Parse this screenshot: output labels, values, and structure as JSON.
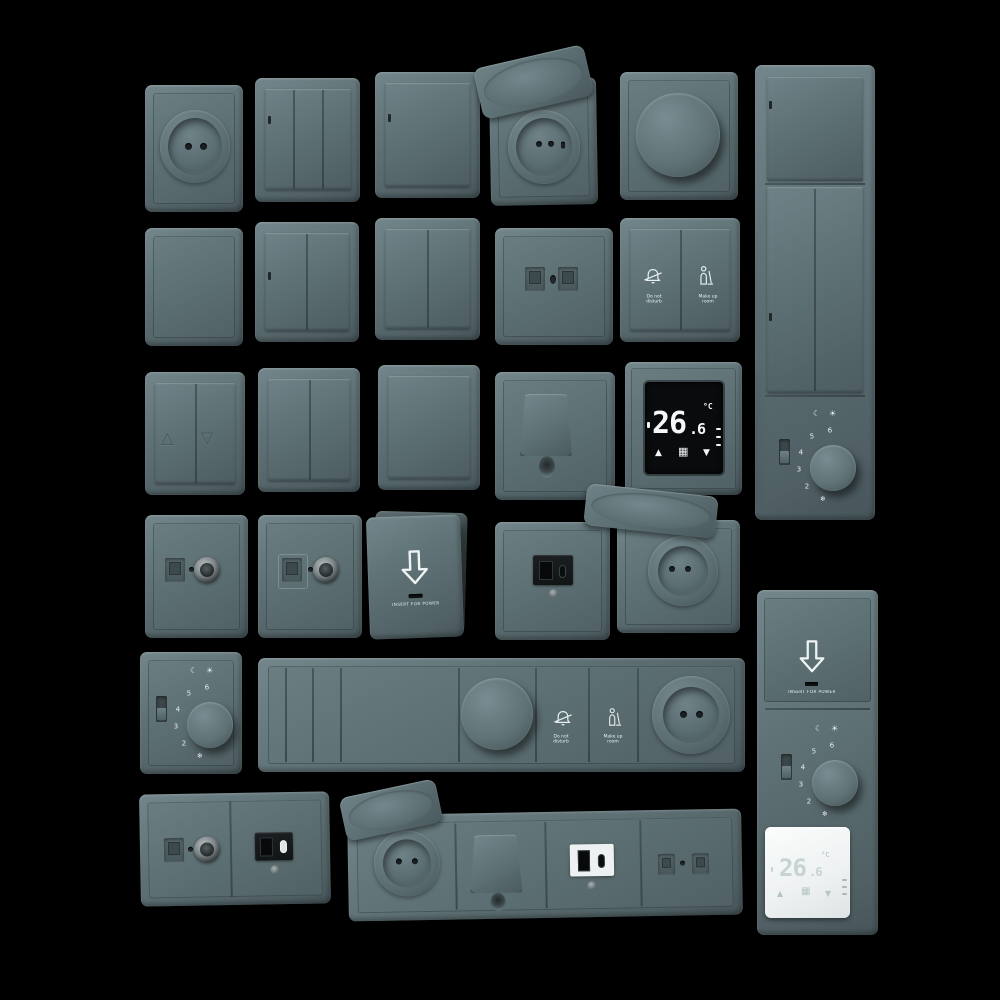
{
  "scene": {
    "background_color": "#000000",
    "plate_color": "#5f7276",
    "plate_highlight": "#72868b",
    "plate_shadow": "#46555a",
    "module_dark_color": "#17191b",
    "screen_color": "#0a0b0c",
    "white_plate_color": "#f0f3f3",
    "digit_color_black_screen": "#f4f8f8",
    "digit_color_white_plate": "#c6d2d4"
  },
  "labels": {
    "insert_for_power": "INSERT FOR POWER",
    "do_not_line1": "Do not",
    "do_not_line2": "disturb",
    "make_up_line1": "Make up",
    "make_up_line2": "room"
  },
  "thermostat_black": {
    "temp": "26",
    "temp_dec": ".6",
    "unit": "°C"
  },
  "thermostat_white": {
    "temp": "26",
    "temp_dec": ".6",
    "unit": "°C"
  },
  "dial": {
    "numbers": [
      "2",
      "3",
      "4",
      "5",
      "6"
    ]
  },
  "icons": {
    "moon": "☾",
    "sun": "☀",
    "snowflake": "❄",
    "triangle_up_outline": "△",
    "triangle_down_outline": "▽",
    "arrow_up": "▲",
    "arrow_down": "▼",
    "grid": "▦"
  }
}
